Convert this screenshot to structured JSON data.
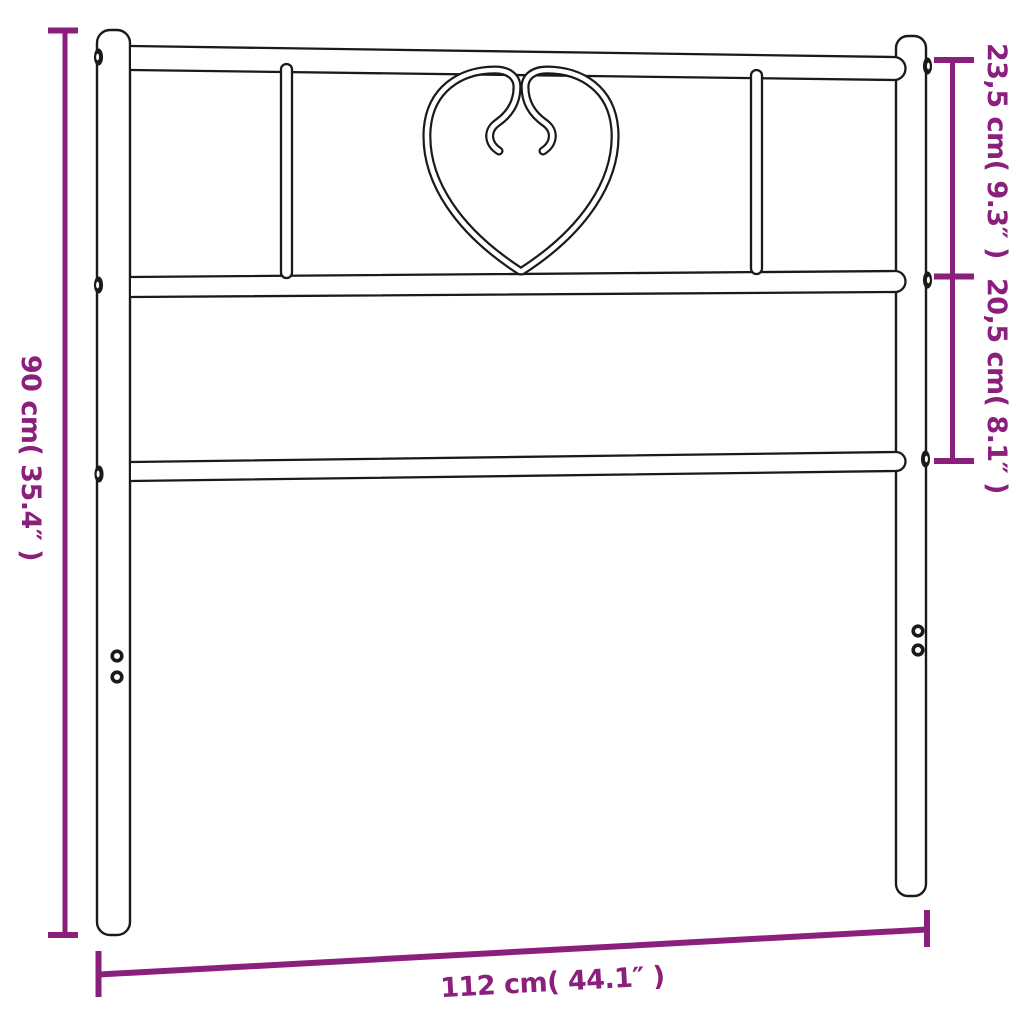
{
  "palette": {
    "accent": "#8A1F7C",
    "outline": "#1A1A1A",
    "background": "#FFFFFF"
  },
  "diagram": {
    "subject": "metal-headboard-with-heart-ornament",
    "dimensions": {
      "total_height": {
        "metric": "90 cm",
        "imperial": "35.4″",
        "label": "90 cm( 35.4″ )"
      },
      "upper_section_height": {
        "metric": "23,5 cm",
        "imperial": "9.3″",
        "label": "23,5 cm( 9.3″ )"
      },
      "middle_section_height": {
        "metric": "20,5 cm",
        "imperial": "8.1″",
        "label": "20,5 cm( 8.1″ )"
      },
      "total_width": {
        "metric": "112 cm",
        "imperial": "44.1″",
        "label": "112 cm( 44.1″ )"
      }
    }
  }
}
